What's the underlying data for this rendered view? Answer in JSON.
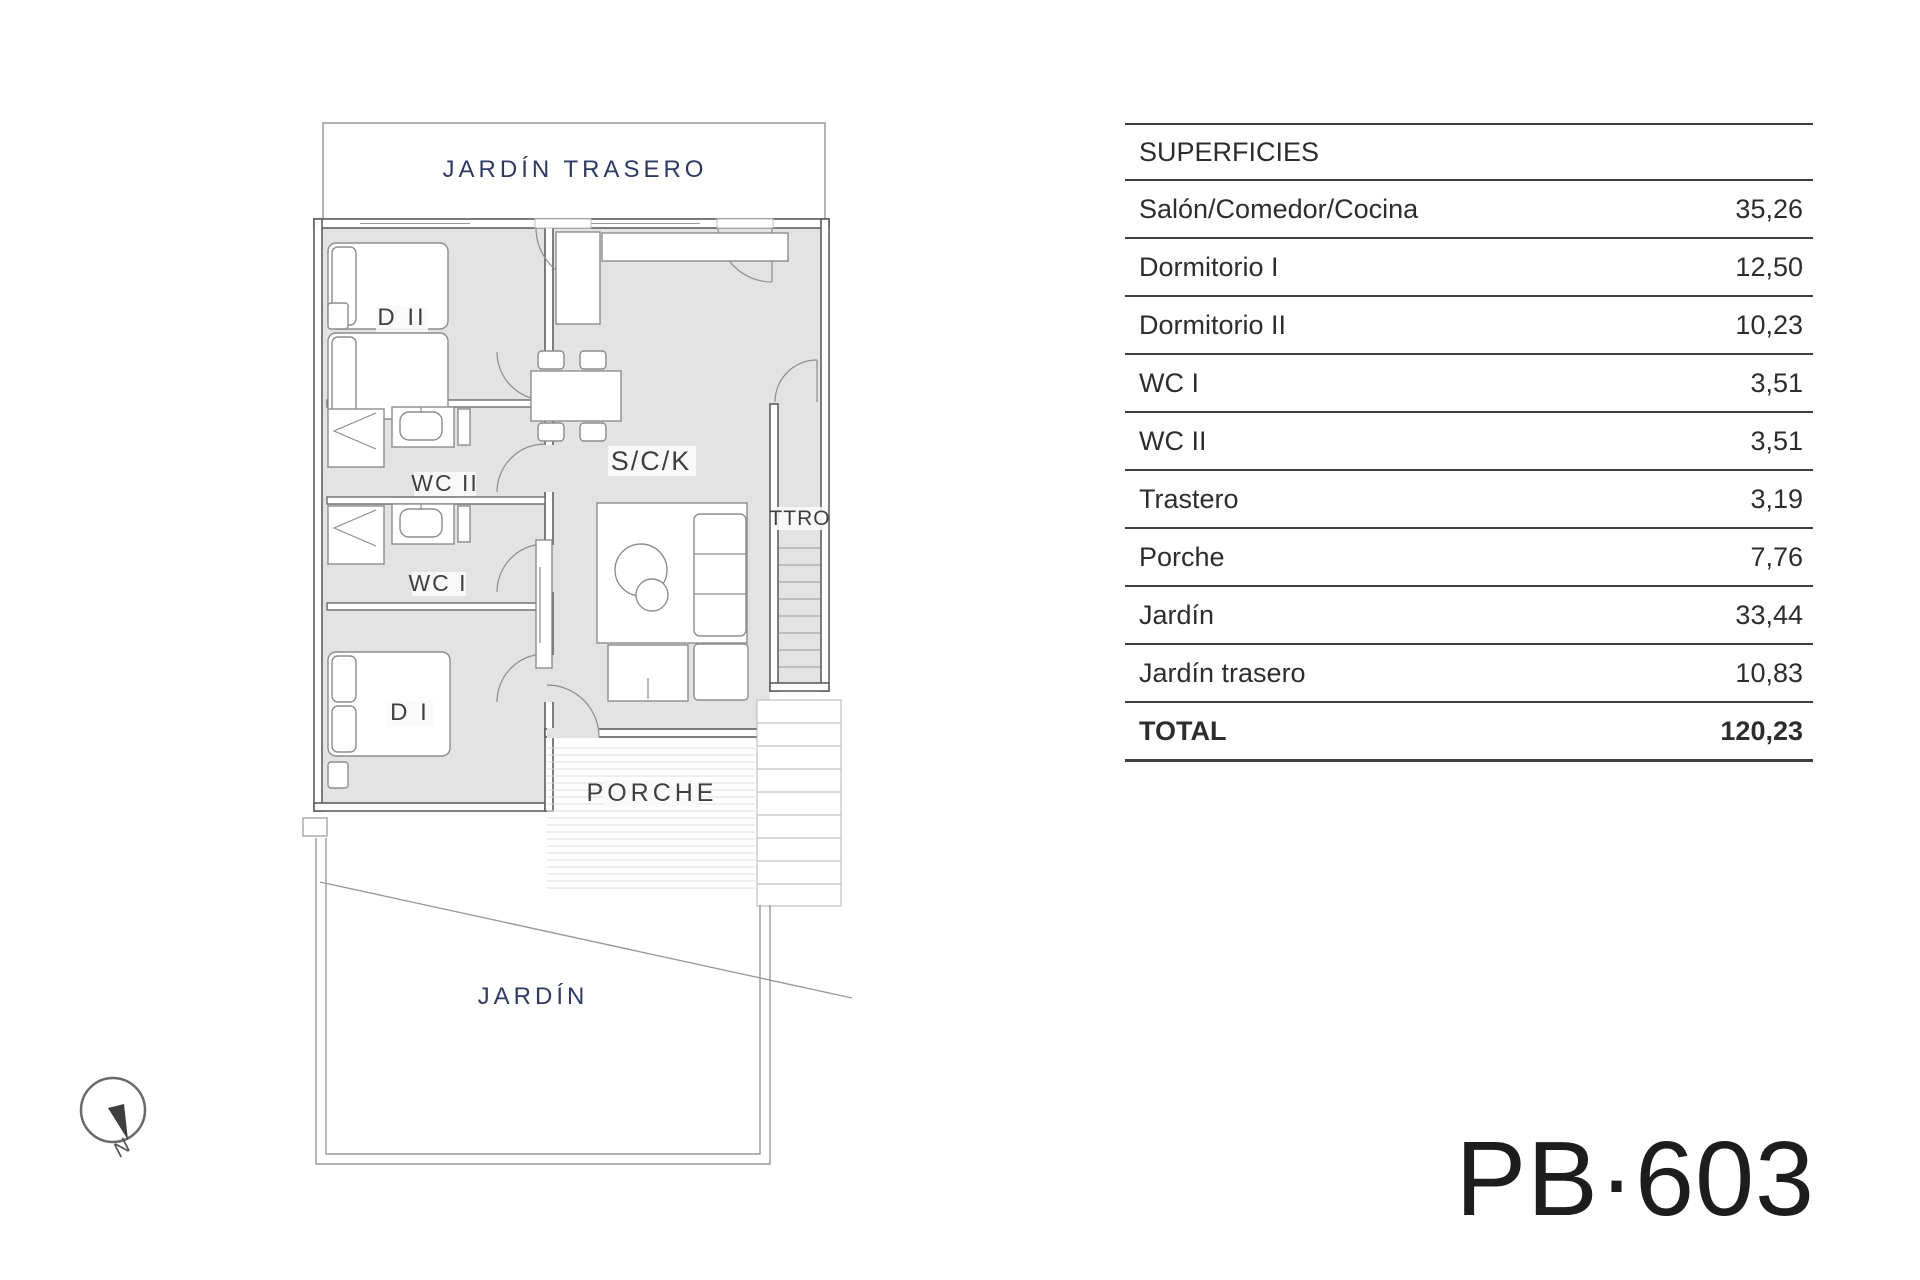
{
  "document": {
    "code": "PB·603"
  },
  "table": {
    "header": "SUPERFICIES",
    "rows": [
      {
        "label": "Salón/Comedor/Cocina",
        "value": "35,26"
      },
      {
        "label": "Dormitorio I",
        "value": "12,50"
      },
      {
        "label": "Dormitorio II",
        "value": "10,23"
      },
      {
        "label": "WC I",
        "value": "3,51"
      },
      {
        "label": "WC II",
        "value": "3,51"
      },
      {
        "label": "Trastero",
        "value": "3,19"
      },
      {
        "label": "Porche",
        "value": "7,76"
      },
      {
        "label": "Jardín",
        "value": "33,44"
      },
      {
        "label": "Jardín trasero",
        "value": "10,83"
      }
    ],
    "total": {
      "label": "TOTAL",
      "value": "120,23"
    }
  },
  "floorplan": {
    "labels": {
      "jardin_trasero": "JARDÍN TRASERO",
      "d2": "D II",
      "wc2": "WC II",
      "wc1": "WC I",
      "d1": "D I",
      "sck": "S/C/K",
      "ttro": "TTRO",
      "porche": "PORCHE",
      "jardin": "JARDÍN",
      "north": "N"
    },
    "colors": {
      "floor": "#e3e3e3",
      "wall": "#5f5f5f",
      "garden_label": "#2f3a63",
      "room_label": "#3f3f3f"
    }
  }
}
